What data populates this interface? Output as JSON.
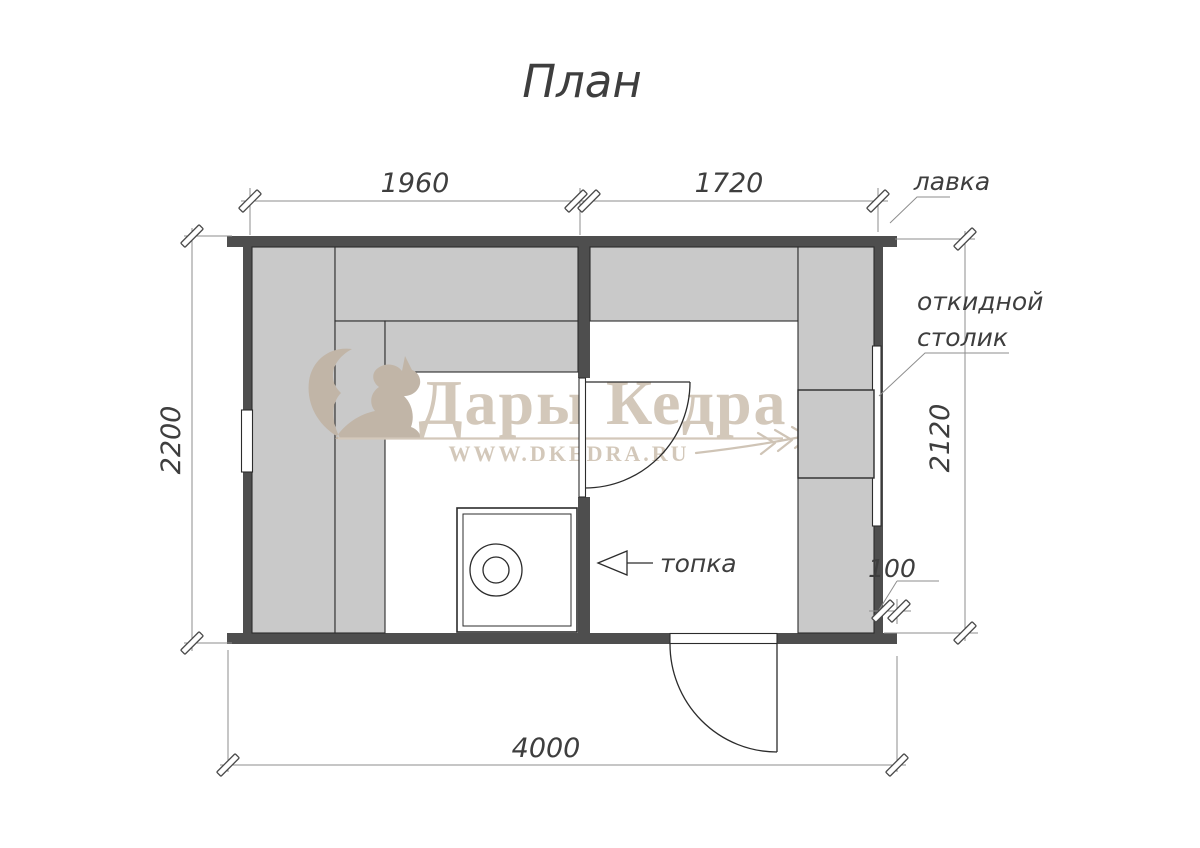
{
  "title": "План",
  "watermark": {
    "brand": "Дары Кедра",
    "url": "WWW.DKEDRA.RU"
  },
  "dimensions": {
    "top_left_mm": "1960",
    "top_right_mm": "1720",
    "left_mm": "2200",
    "right_mm": "2120",
    "bottom_mm": "4000",
    "wall_ledge_mm": "100"
  },
  "labels": {
    "bench": "лавка",
    "folding_table_line1": "откидной",
    "folding_table_line2": "столик",
    "firebox": "топка"
  },
  "plan": {
    "type": "sauna-floor-plan",
    "rooms": 2,
    "features": [
      "benches",
      "stove",
      "interior-door",
      "exterior-door",
      "window",
      "folding-table"
    ]
  },
  "colors": {
    "wall": "#4e4e4e",
    "bench_fill": "#c9c9c9",
    "line": "#2c2c2c",
    "dimension_line": "#8e8e8e",
    "text": "#3e3e3e",
    "watermark": "#d3c8ba",
    "watermark_logo": "#c1b5a7",
    "background": "#ffffff"
  }
}
